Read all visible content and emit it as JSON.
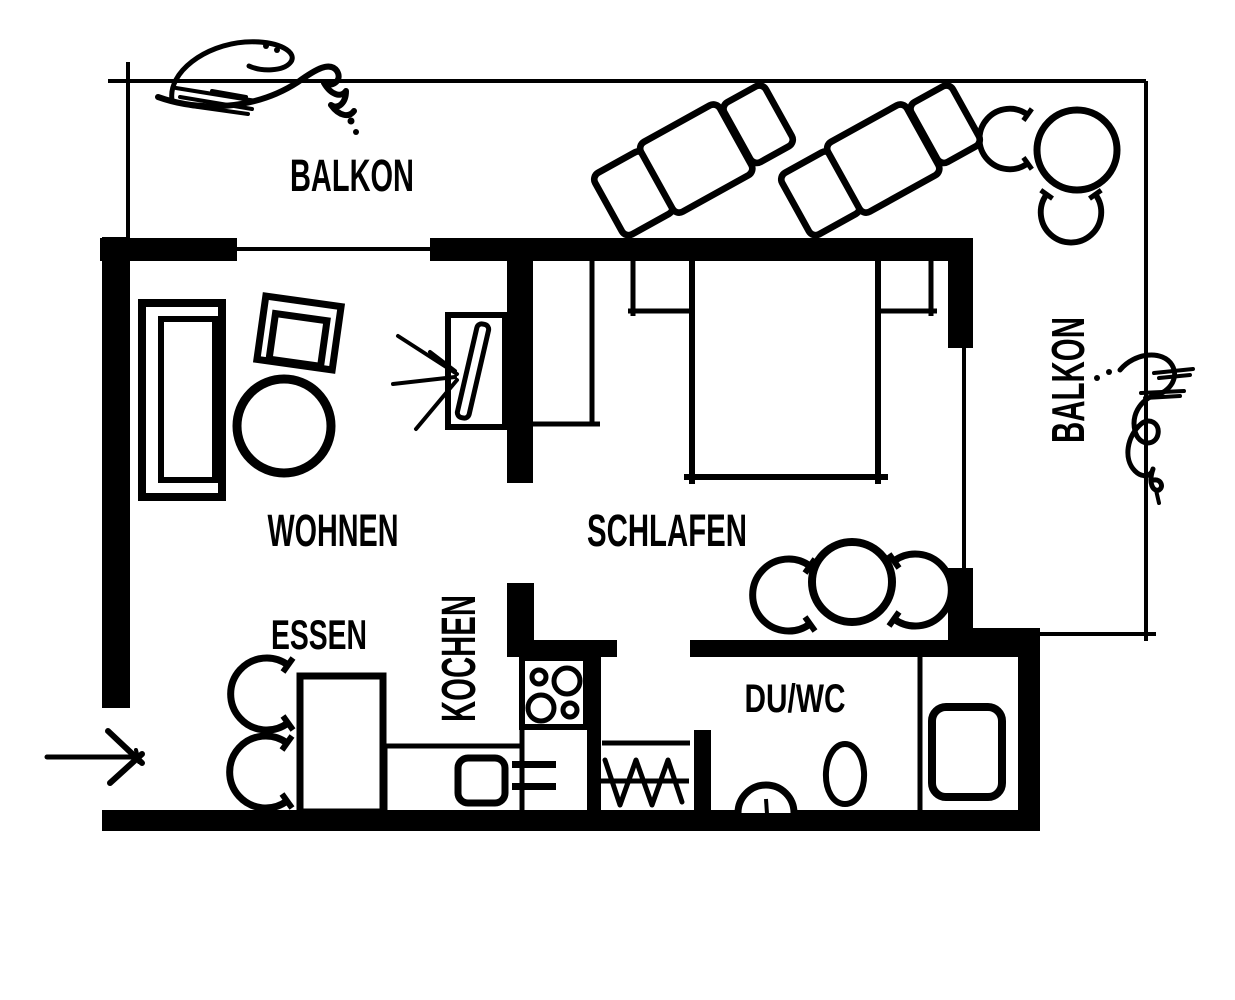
{
  "page": {
    "title": "Apartment floor plan sketch",
    "background": "#ffffff",
    "ink": "#000000"
  },
  "labels": {
    "balkon_top": "BALKON",
    "balkon_right": "BALKON",
    "wohnen": "WOHNEN",
    "schlafen": "SCHLAFEN",
    "essen": "ESSEN",
    "kochen": "KOCHEN",
    "du_wc": "DU/WC"
  },
  "symbols": {
    "entrance": "entrance-arrow-icon",
    "balcony_furniture": [
      "sun-lounger",
      "sun-lounger",
      "round-table",
      "chair",
      "chair"
    ],
    "wohnen_furniture": [
      "sofa",
      "armchair",
      "coffee-table",
      "tv"
    ],
    "schlafen_furniture": [
      "wardrobe",
      "double-bed",
      "nightstand",
      "nightstand",
      "round-table",
      "chair",
      "chair"
    ],
    "essen_furniture": [
      "dining-table",
      "chair",
      "chair"
    ],
    "kochen_furniture": [
      "stove",
      "sink",
      "counter"
    ],
    "du_wc_furniture": [
      "radiator",
      "washbasin",
      "toilet",
      "shower"
    ],
    "decor": [
      "plant-scribble",
      "plant-scribble"
    ]
  }
}
